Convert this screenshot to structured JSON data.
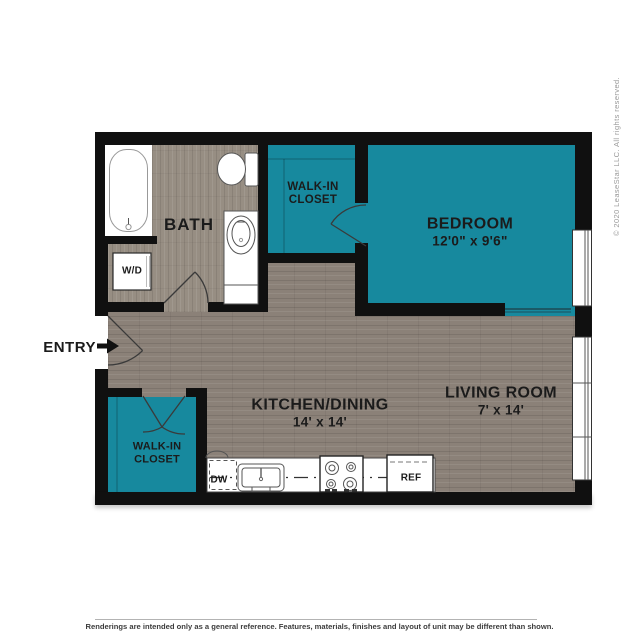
{
  "colors": {
    "teal": "#17899e",
    "wall": "#101010",
    "floor": "#8b8178",
    "floor_bath": "#978e83"
  },
  "copyright": "© 2020 LeaseStar LLC. All rights reserved.",
  "entry": {
    "label": "ENTRY"
  },
  "rooms": {
    "bath": {
      "label": "BATH"
    },
    "bedroom": {
      "label": "BEDROOM",
      "dims": "12'0\" x 9'6\""
    },
    "kitchen": {
      "label": "KITCHEN/DINING",
      "dims": "14' x 14'"
    },
    "living": {
      "label": "LIVING ROOM",
      "dims": "7' x 14'"
    },
    "closet_top": {
      "line1": "WALK-IN",
      "line2": "CLOSET"
    },
    "closet_bottom": {
      "line1": "WALK-IN",
      "line2": "CLOSET"
    }
  },
  "fixtures": {
    "washer_dryer": "W/D",
    "dishwasher": "DW",
    "refrigerator": "REF"
  },
  "footer": {
    "disclaimer": "Renderings are intended only as a general reference. Features, materials, finishes and layout of unit may be different than shown."
  }
}
